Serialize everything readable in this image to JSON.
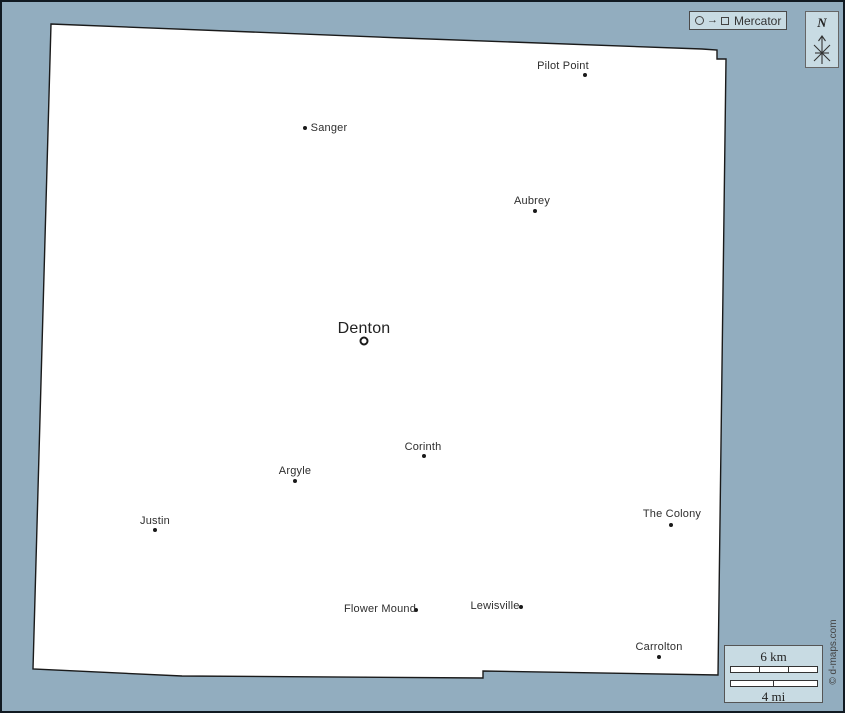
{
  "map": {
    "title": "Denton county outline map",
    "projection_legend": {
      "label": "Mercator"
    },
    "compass": {
      "label": "N"
    },
    "scale": {
      "km_label": "6 km",
      "mi_label": "4 mi"
    },
    "copyright": "© d-maps.com",
    "colors": {
      "background": "#92adbf",
      "land": "#ffffff",
      "outline": "#1a1a1a",
      "panel": "#c8dbe3",
      "label_text": "#2e2e2e"
    },
    "cities": [
      {
        "name": "Pilot Point",
        "label": {
          "x": 561,
          "y": 64
        },
        "marker": {
          "x": 583,
          "y": 73,
          "type": "dot"
        },
        "size": "small"
      },
      {
        "name": "Sanger",
        "label": {
          "x": 327,
          "y": 126
        },
        "marker": {
          "x": 303,
          "y": 126,
          "type": "dot"
        },
        "size": "small"
      },
      {
        "name": "Aubrey",
        "label": {
          "x": 530,
          "y": 199
        },
        "marker": {
          "x": 533,
          "y": 209,
          "type": "dot"
        },
        "size": "small"
      },
      {
        "name": "Denton",
        "label": {
          "x": 362,
          "y": 327
        },
        "marker": {
          "x": 362,
          "y": 339,
          "type": "ring"
        },
        "size": "large"
      },
      {
        "name": "Corinth",
        "label": {
          "x": 421,
          "y": 445
        },
        "marker": {
          "x": 422,
          "y": 454,
          "type": "dot"
        },
        "size": "small"
      },
      {
        "name": "Argyle",
        "label": {
          "x": 293,
          "y": 469
        },
        "marker": {
          "x": 293,
          "y": 479,
          "type": "dot"
        },
        "size": "small"
      },
      {
        "name": "Justin",
        "label": {
          "x": 153,
          "y": 519
        },
        "marker": {
          "x": 153,
          "y": 528,
          "type": "dot"
        },
        "size": "small"
      },
      {
        "name": "The Colony",
        "label": {
          "x": 670,
          "y": 512
        },
        "marker": {
          "x": 669,
          "y": 523,
          "type": "dot"
        },
        "size": "small"
      },
      {
        "name": "Flower Mound",
        "label": {
          "x": 378,
          "y": 607
        },
        "marker": {
          "x": 414,
          "y": 608,
          "type": "dot"
        },
        "size": "small"
      },
      {
        "name": "Lewisville",
        "label": {
          "x": 493,
          "y": 604
        },
        "marker": {
          "x": 519,
          "y": 605,
          "type": "dot"
        },
        "size": "small"
      },
      {
        "name": "Carrolton",
        "label": {
          "x": 657,
          "y": 645
        },
        "marker": {
          "x": 657,
          "y": 655,
          "type": "dot"
        },
        "size": "small"
      }
    ]
  }
}
